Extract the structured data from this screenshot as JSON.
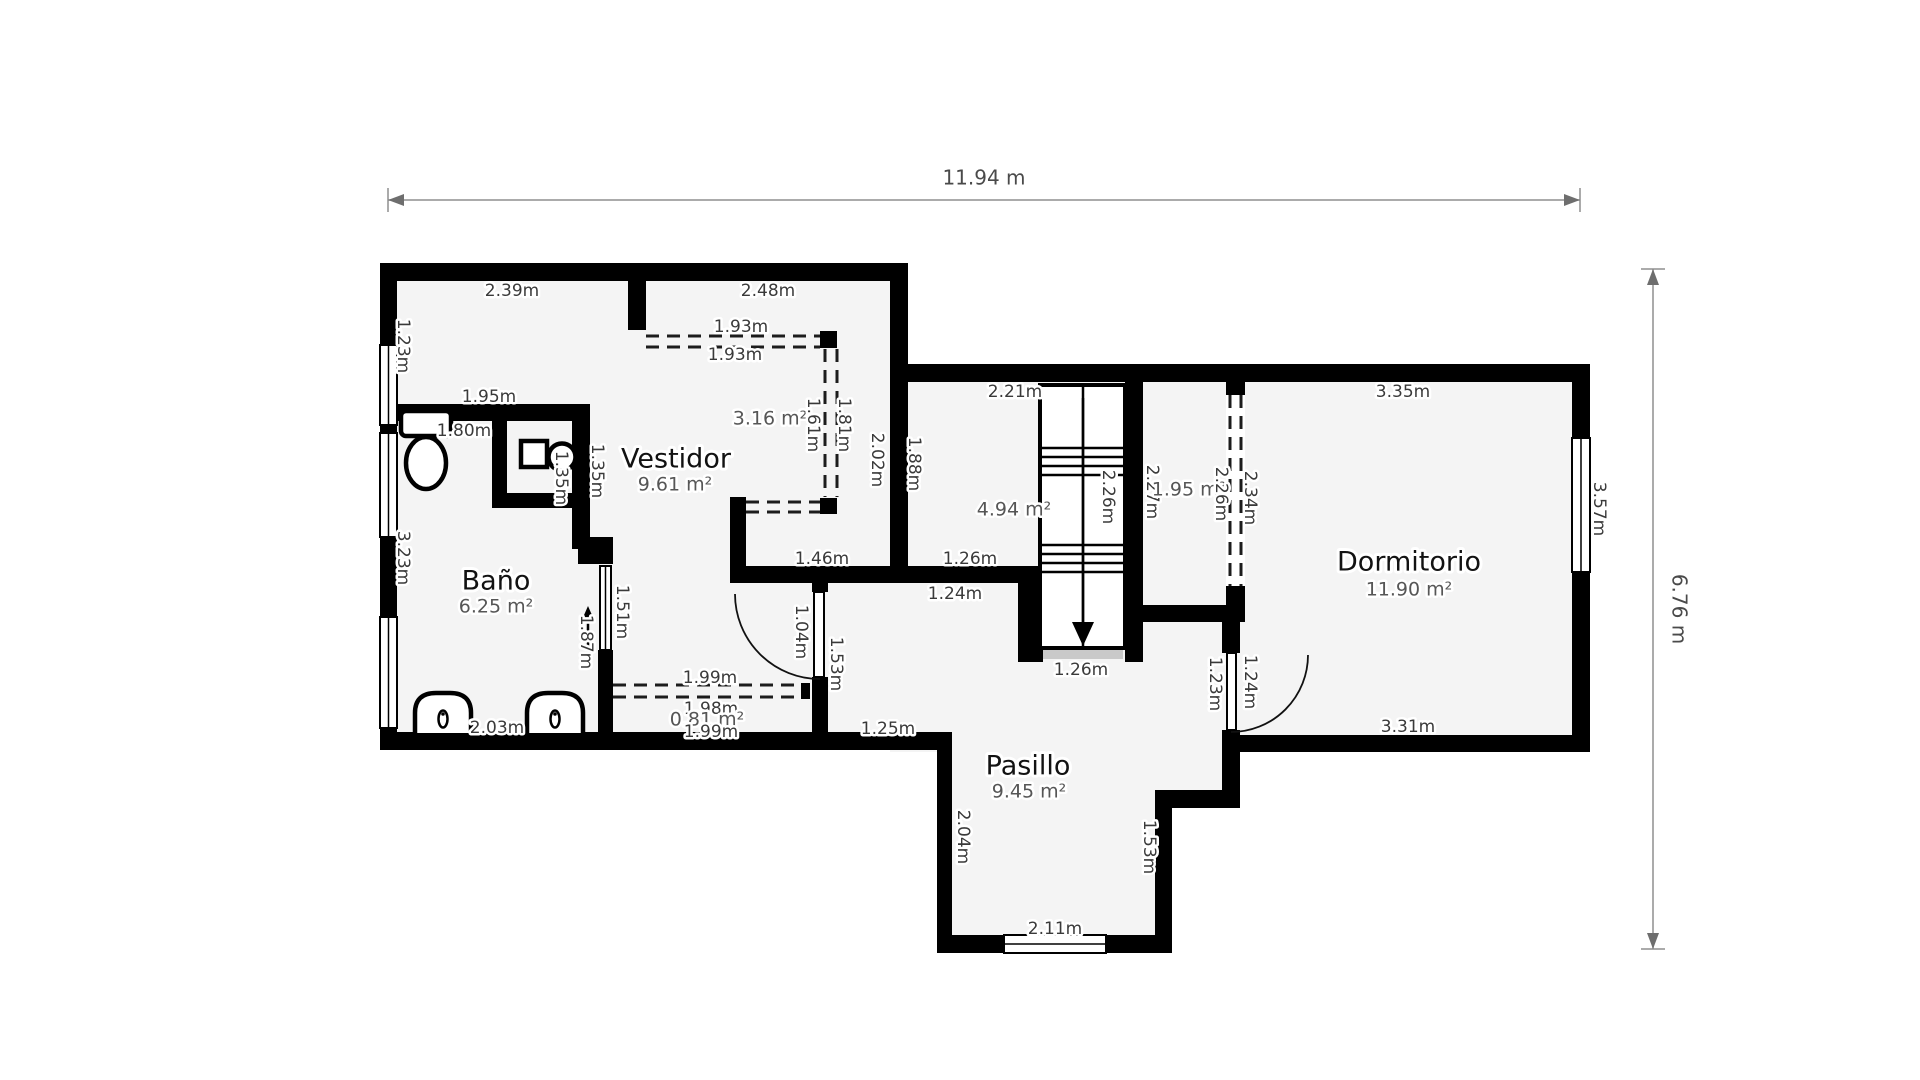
{
  "plan": {
    "overall_width": "11.94 m",
    "overall_height": "6.76 m"
  },
  "rooms": [
    {
      "name": "Baño",
      "area": "6.25 m²"
    },
    {
      "name": "Vestidor",
      "area": "9.61 m²"
    },
    {
      "name": "Pasillo",
      "area": "9.45 m²"
    },
    {
      "name": "Dormitorio",
      "area": "11.90 m²"
    }
  ],
  "labels": [
    {
      "t": "2.39m"
    },
    {
      "t": "2.48m"
    },
    {
      "t": "1.23m"
    },
    {
      "t": "1.93m"
    },
    {
      "t": "1.93m"
    },
    {
      "t": "1.95m"
    },
    {
      "t": "1.80m"
    },
    {
      "t": "1.35m"
    },
    {
      "t": "1.35m"
    },
    {
      "t": "3.16 m²"
    },
    {
      "t": "1.61m"
    },
    {
      "t": "1.81m"
    },
    {
      "t": "2.02m"
    },
    {
      "t": "1.88m"
    },
    {
      "t": "2.21m"
    },
    {
      "t": "4.94 m²"
    },
    {
      "t": "2.26m"
    },
    {
      "t": "2.27m"
    },
    {
      "t": "1.95 m²"
    },
    {
      "t": "2.26m"
    },
    {
      "t": "2.34m"
    },
    {
      "t": "3.35m"
    },
    {
      "t": "3.57m"
    },
    {
      "t": "3.23m"
    },
    {
      "t": "1.51m"
    },
    {
      "t": "1.87m"
    },
    {
      "t": "1.46m"
    },
    {
      "t": "1.26m"
    },
    {
      "t": "1.24m"
    },
    {
      "t": "1.04m"
    },
    {
      "t": "1.53m"
    },
    {
      "t": "1.99m"
    },
    {
      "t": "1.98m"
    },
    {
      "t": "0.81 m²"
    },
    {
      "t": "1.99m"
    },
    {
      "t": "2.03m"
    },
    {
      "t": "1.25m"
    },
    {
      "t": "1.26m"
    },
    {
      "t": "2.04m"
    },
    {
      "t": "2.11m"
    },
    {
      "t": "1.53m"
    },
    {
      "t": "1.23m"
    },
    {
      "t": "1.24m"
    },
    {
      "t": "3.31m"
    }
  ]
}
